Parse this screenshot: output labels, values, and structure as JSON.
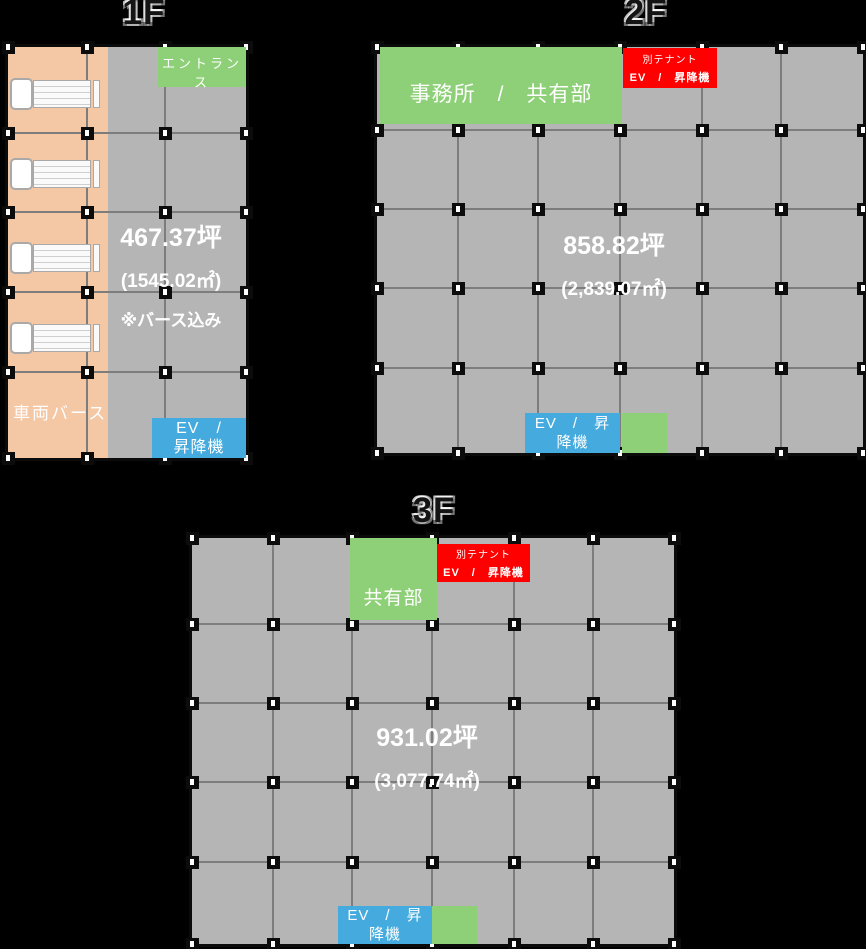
{
  "colors": {
    "background": "#000000",
    "floor_gray": "#b5b5b5",
    "grid_line": "#7d7d7d",
    "berth_peach": "#f4c7a5",
    "zone_green": "#8ed077",
    "ev_blue": "#45aadd",
    "tenant_red": "#fe0000",
    "text_white": "#ffffff"
  },
  "floors": [
    {
      "title": "1F",
      "area_tsubo": "467.37坪",
      "area_m2": "(1545.02㎡)",
      "area_note": "※バース込み",
      "entrance_label": "エントランス",
      "berth_label": "車両バース",
      "ev_lines": [
        "EV　/",
        "昇降機"
      ]
    },
    {
      "title": "2F",
      "area_tsubo": "858.82坪",
      "area_m2": "(2,839.07㎡)",
      "office_label": "事務所　/　共有部",
      "tenant_lines": [
        "別テナント",
        "EV　/　昇降機"
      ],
      "ev_lines": [
        "EV　/　昇",
        "降機"
      ]
    },
    {
      "title": "3F",
      "area_tsubo": "931.02坪",
      "area_m2": "(3,077.74㎡)",
      "common_label": "共有部",
      "tenant_lines": [
        "別テナント",
        "EV　/　昇降機"
      ],
      "ev_lines": [
        "EV　/　昇",
        "降機"
      ]
    }
  ]
}
